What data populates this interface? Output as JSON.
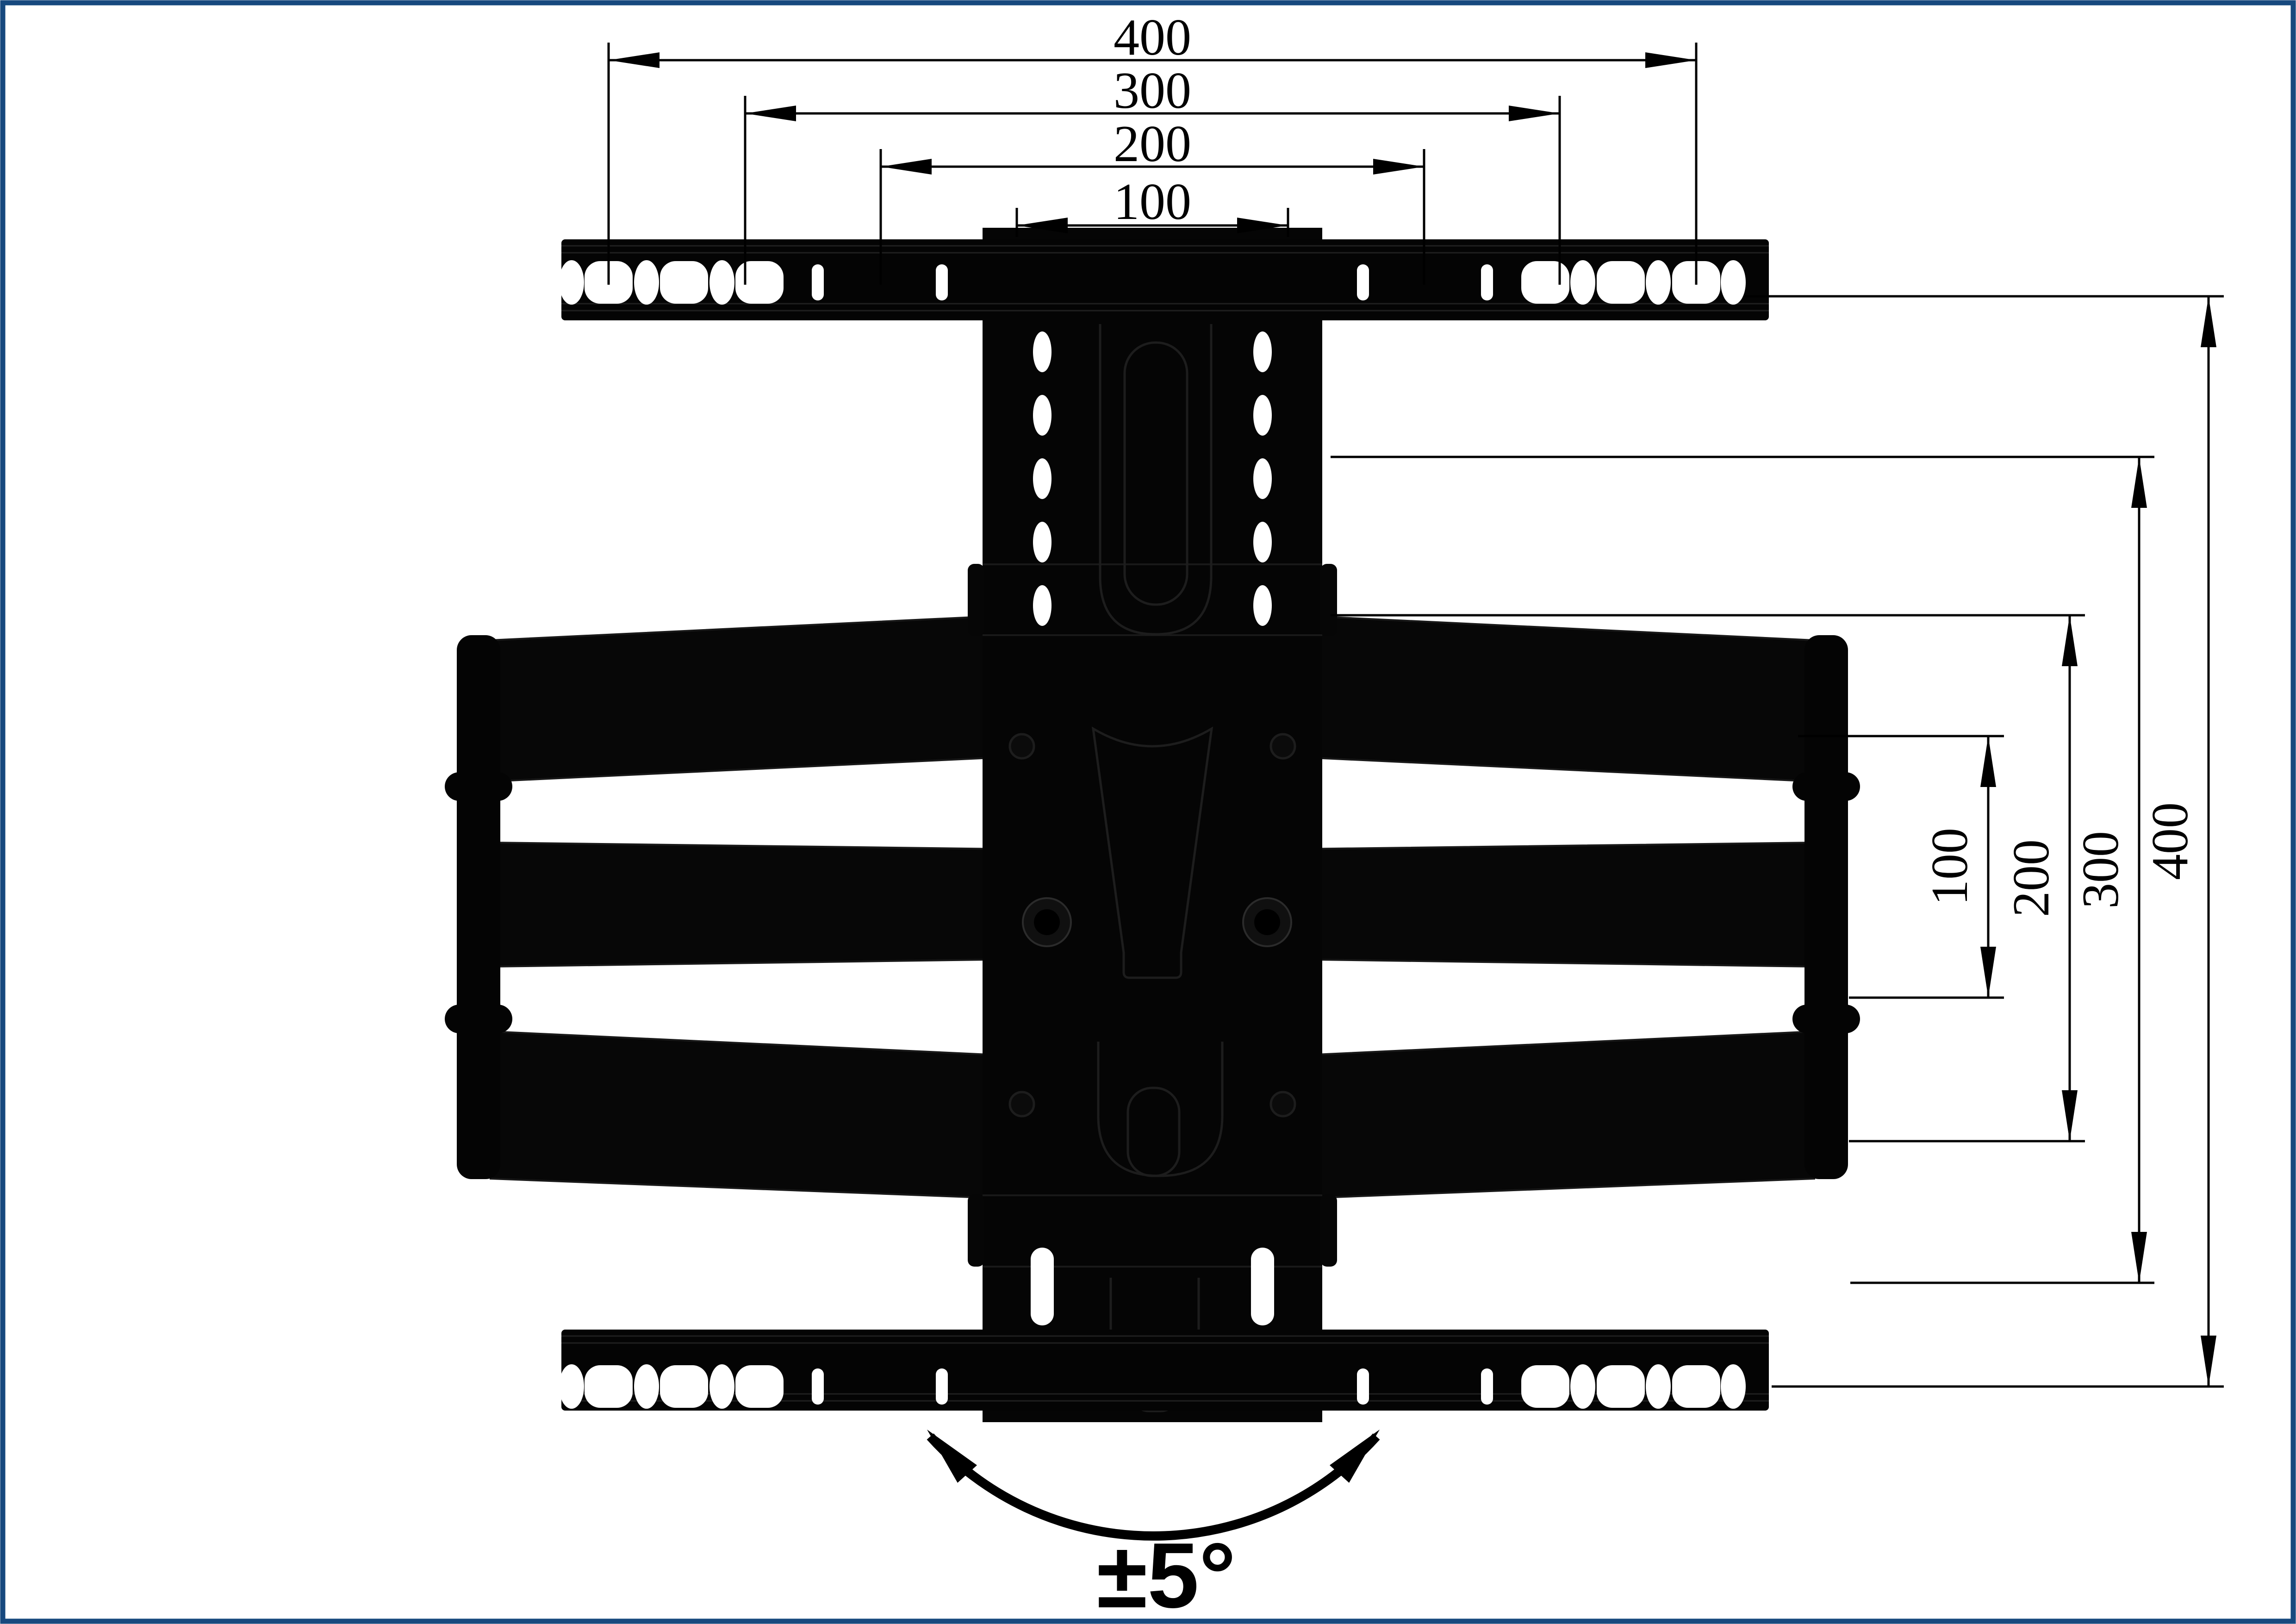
{
  "page": {
    "background": "#ffffff",
    "frame_color": "#17497e"
  },
  "colors": {
    "ink": "#000000",
    "hardware_black": "#050505",
    "hole_white": "#ffffff"
  },
  "dimensions": {
    "top": [
      {
        "label": "400"
      },
      {
        "label": "300"
      },
      {
        "label": "200"
      },
      {
        "label": "100"
      }
    ],
    "right": [
      {
        "label": "100"
      },
      {
        "label": "200"
      },
      {
        "label": "300"
      },
      {
        "label": "400"
      }
    ]
  },
  "swivel": {
    "label": "±5°"
  }
}
